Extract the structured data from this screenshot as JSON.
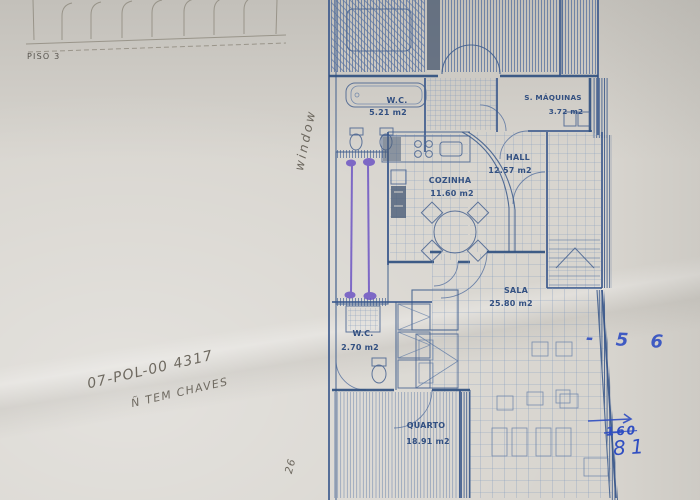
{
  "plan": {
    "floor_label": "PISO 3",
    "rooms": [
      {
        "name": "W.C.",
        "area": "5.21 m2"
      },
      {
        "name": "S. MÁQUINAS",
        "area": "3.72 m2"
      },
      {
        "name": "HALL",
        "area": "12.57 m2"
      },
      {
        "name": "COZINHA",
        "area": "11.60 m2"
      },
      {
        "name": "SALA",
        "area": "25.80 m2"
      },
      {
        "name": "W.C.",
        "area": "2.70 m2"
      },
      {
        "name": "QUARTO",
        "area": "18.91 m2"
      }
    ],
    "ink_color": "#3c5a8a",
    "marker_color": "#6d55c4"
  },
  "annotations": {
    "reference_code": "07-POL-00 4317",
    "keys_note": "Ñ TEM CHAVES",
    "window_note": "window",
    "measure_note": "- 5 6",
    "crossed_value": "160",
    "final_value": "81",
    "corner_note": "26",
    "pen_color": "#2f4ec2",
    "pencil_color": "#6e6960"
  }
}
